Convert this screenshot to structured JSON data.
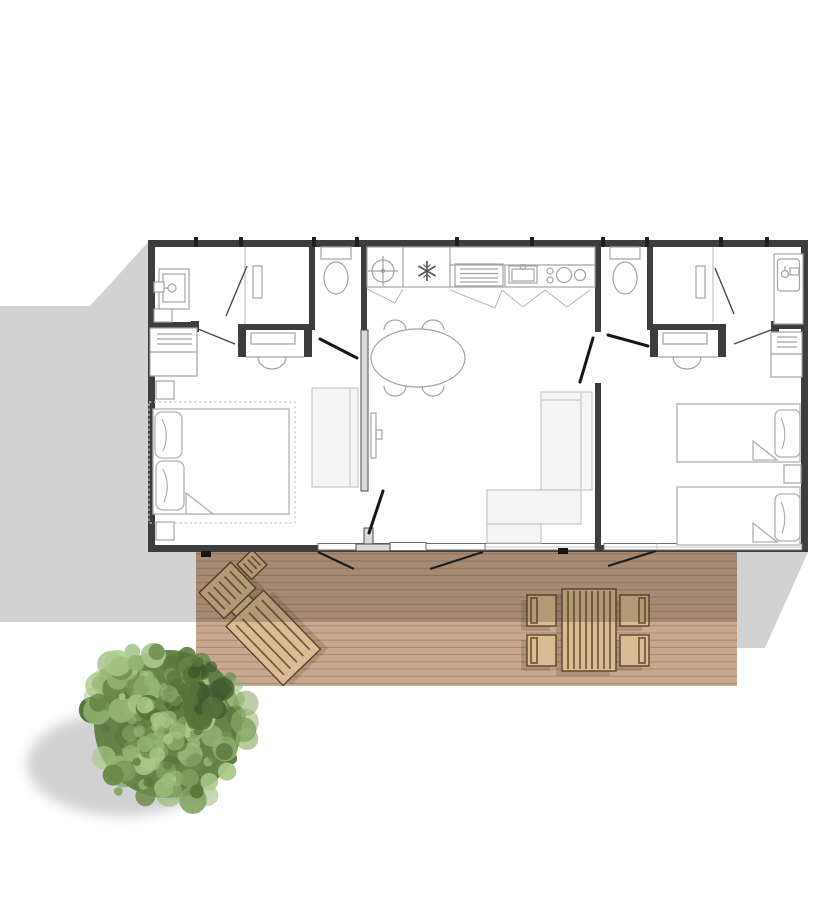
{
  "scene": {
    "kind": "architectural-floor-plan",
    "view": "top-down",
    "areas": [
      "bedroom-left",
      "bathroom-left",
      "wc-left",
      "kitchen-living",
      "wc-right",
      "bedroom-right",
      "bathroom-right",
      "wood-deck",
      "garden"
    ],
    "furniture": [
      "double-bed",
      "single-bed",
      "single-bed",
      "pillow",
      "nightstand",
      "bench-sofa",
      "corner-sofa",
      "dining-table-oval",
      "chair",
      "desk-with-stool",
      "desk-with-stool",
      "shelf-unit",
      "shelf-unit",
      "wardrobe-rail",
      "wardrobe-rail",
      "tv",
      "sun-lounger",
      "lounger-side-table",
      "outdoor-dining-table",
      "outdoor-chair",
      "outdoor-chair",
      "outdoor-chair",
      "outdoor-chair"
    ],
    "fixtures": [
      "washbasin",
      "shower-basin",
      "toilet",
      "toilet",
      "water-heater",
      "fridge",
      "kitchen-vent-unit",
      "kitchen-sink",
      "stove",
      "entrance-double-door",
      "deck-door",
      "interior-door",
      "window-band"
    ],
    "nature": [
      "tree",
      "tree-shadow",
      "building-shadow"
    ]
  },
  "colors": {
    "background": "#ffffff",
    "ground_shadow": "#d2d2d2",
    "wall": "#3d3d3d",
    "wall_light": "#dadada",
    "window_frame": "#6f6f6f",
    "fixture": "#a3a3a3",
    "soft_fill": "#f5f5f5",
    "soft_line": "#c6c6c6",
    "door_leaf": "#161616",
    "door_leaf_thin": "#4a4a4a",
    "deck": "#c8a88e",
    "deck_line": "rgba(92,63,40,0.32)",
    "deck_shade": "rgba(64,44,30,0.24)",
    "wood": "#d8bc94",
    "wood_line": "#74573a",
    "wood_edge": "#5d4429",
    "tree_shadow": "#c9c9c9",
    "tree_greens": [
      "#3f5a2e",
      "#557538",
      "#6b8a4a",
      "#7fa05e",
      "#93b573",
      "#a9c98a"
    ]
  }
}
